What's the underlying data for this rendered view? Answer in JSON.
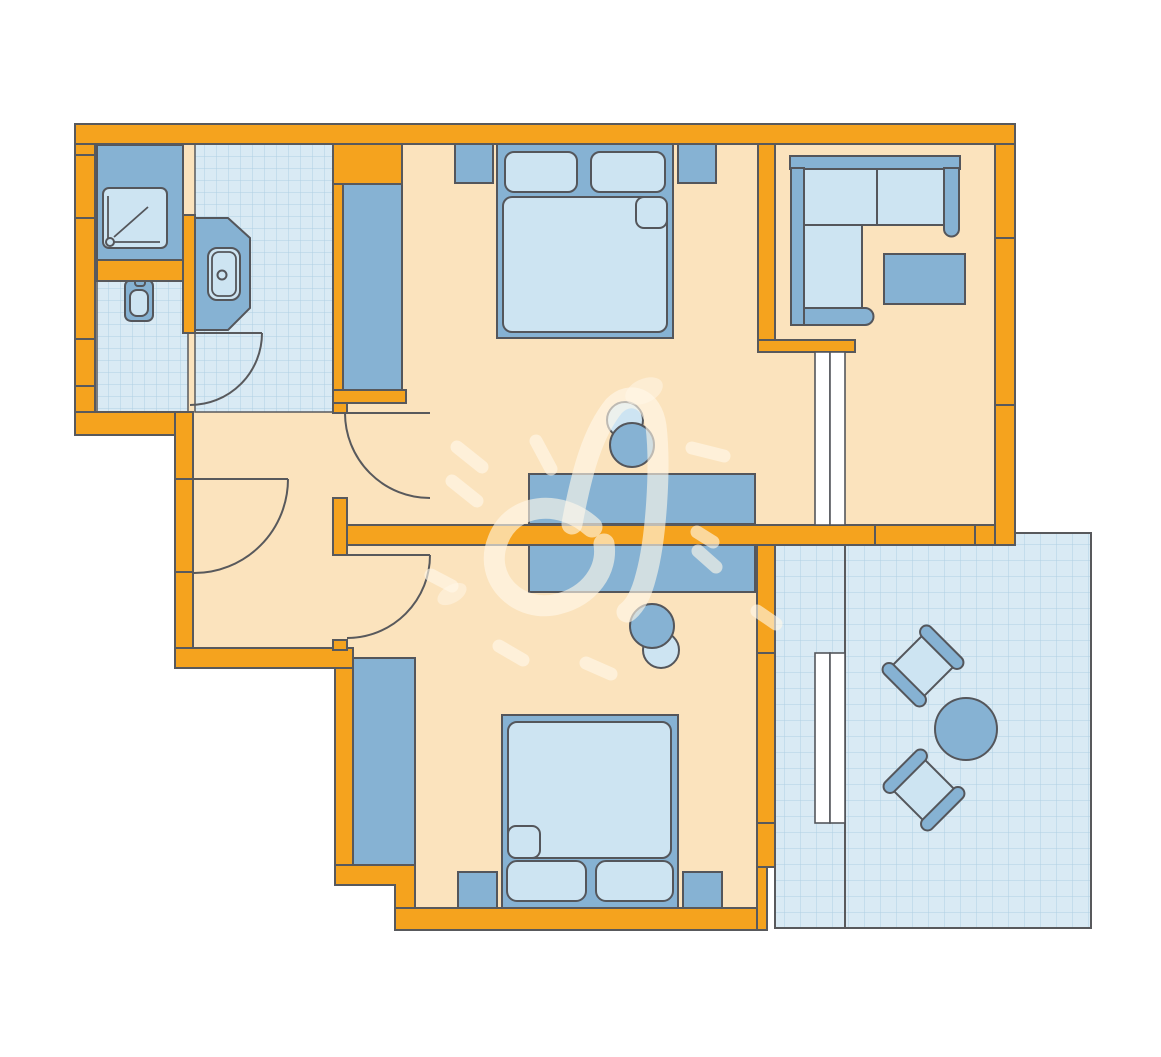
{
  "title": "apartment-floor-plan",
  "colors": {
    "background": "#FFFFFF",
    "wall": "#F5A31E",
    "wall_outline": "#58595C",
    "floor": "#FBE3BD",
    "tile": "#D9EAF4",
    "tile_grid": "#AFD0E3",
    "furniture": "#86B2D3",
    "furniture_light": "#CDE4F2",
    "furniture_outline": "#54565B",
    "sliding_door": "#FFFFFF",
    "watermark": "#FFF8EA"
  },
  "rooms": [
    {
      "name": "bathroom",
      "floor": "tiled",
      "furniture": [
        "shower",
        "toilet",
        "washbasin-vanity",
        "door"
      ]
    },
    {
      "name": "hallway",
      "floor": "plain",
      "furniture": [
        "entry-door",
        "door-to-bedroom-top",
        "door-to-bedroom-bottom"
      ]
    },
    {
      "name": "bedroom-top",
      "floor": "plain",
      "furniture": [
        "double-bed",
        "nightstand-left",
        "nightstand-right",
        "wardrobe",
        "desk",
        "desk-chair"
      ]
    },
    {
      "name": "living-area",
      "floor": "plain",
      "furniture": [
        "corner-sofa",
        "coffee-table",
        "sliding-door"
      ]
    },
    {
      "name": "bedroom-bottom",
      "floor": "plain",
      "furniture": [
        "double-bed",
        "nightstand-left",
        "nightstand-right",
        "wardrobe",
        "desk",
        "desk-chair",
        "sliding-door"
      ]
    },
    {
      "name": "terrace",
      "floor": "tiled",
      "furniture": [
        "round-table",
        "armchair-top",
        "armchair-bottom"
      ]
    }
  ],
  "watermark": "hand-drawn-heart-with-dashes"
}
